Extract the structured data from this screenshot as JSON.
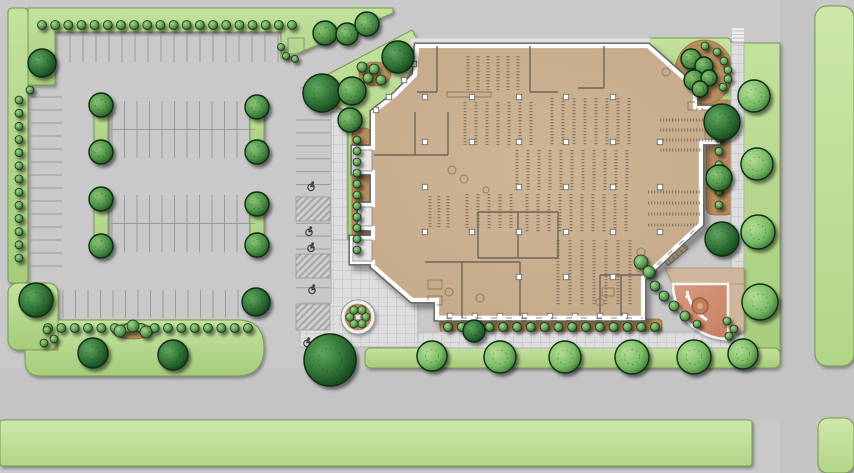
{
  "meta": {
    "type": "architectural-site-plan",
    "content": "color site plan: building floor plan with library-style shelving, parking lot, landscaping, plaza and roads",
    "text_labels": []
  },
  "canvas": {
    "w": 854,
    "h": 473,
    "bg": "#c9c9c9"
  },
  "palette": {
    "asphalt": "#c9c9c9",
    "road": "#c4c4c4",
    "grassStroke": "#7a9a52",
    "mulch": "#b78d5e",
    "mulchStroke": "#96713e",
    "walkFill": "#dedede",
    "walkLine": "#c0c0c0",
    "walkStroke": "#b2b2b2",
    "wallDark": "#5d5d5d",
    "wallWhite": "#fdfdfd",
    "shelf": "#7e6d58",
    "partition": "#6f655a",
    "stall": "#9b9b9b",
    "hatch": "#a6a6a6",
    "hcSymbol": "#3f3f3f",
    "plazaStroke": "#a96b50",
    "pavingTan": "#cfb79b",
    "fountain": "#c07d5c",
    "fountainRim": "#9c5f42",
    "fountainCore": "#dca584"
  },
  "roads": [
    {
      "x": 0,
      "y": 368,
      "w": 854,
      "h": 52
    },
    {
      "x": 780,
      "y": 0,
      "w": 36,
      "h": 473
    }
  ],
  "greens": [
    {
      "kind": "path",
      "d": "M28,8 H393 V13 L287,58 H281 V32 H55 V85 H28 Z",
      "tone": "main"
    },
    {
      "kind": "rect",
      "x": 8,
      "y": 8,
      "w": 20,
      "h": 275,
      "rx": 4,
      "tone": "main"
    },
    {
      "kind": "rect",
      "x": 8,
      "y": 283,
      "w": 50,
      "h": 67,
      "rx": 10,
      "tone": "main"
    },
    {
      "kind": "path",
      "d": "M25,350 H58 V320 H238 Q264,320 264,348 Q264,376 236,376 H40 Q25,376 25,360 Z",
      "tone": "main"
    },
    {
      "kind": "rect",
      "x": 94,
      "y": 100,
      "w": 14,
      "h": 56,
      "rx": 6,
      "tone": "main"
    },
    {
      "kind": "rect",
      "x": 250,
      "y": 100,
      "w": 14,
      "h": 56,
      "rx": 6,
      "tone": "main"
    },
    {
      "kind": "rect",
      "x": 94,
      "y": 196,
      "w": 14,
      "h": 56,
      "rx": 6,
      "tone": "main"
    },
    {
      "kind": "rect",
      "x": 250,
      "y": 196,
      "w": 14,
      "h": 56,
      "rx": 6,
      "tone": "main"
    },
    {
      "kind": "path",
      "d": "M302,88 L412,30 L424,52 L380,116 L380,268 L348,268 L348,112 Z",
      "tone": "main"
    },
    {
      "kind": "rect",
      "x": 645,
      "y": 38,
      "w": 86,
      "h": 75,
      "rx": 4,
      "tone": "main"
    },
    {
      "kind": "path",
      "d": "M742,43 H780 V350 Q780,366 764,366 H758 Q742,366 742,350 Z",
      "tone": "main"
    },
    {
      "kind": "rect",
      "x": 365,
      "y": 348,
      "w": 415,
      "h": 20,
      "rx": 6,
      "tone": "main"
    },
    {
      "kind": "rect",
      "x": 0,
      "y": 420,
      "w": 752,
      "h": 46,
      "rx": 3,
      "tone": "light"
    },
    {
      "kind": "rect",
      "x": 815,
      "y": 6,
      "w": 39,
      "h": 360,
      "rx": 12,
      "tone": "light"
    },
    {
      "kind": "rect",
      "x": 818,
      "y": 418,
      "w": 36,
      "h": 55,
      "rx": 10,
      "tone": "light"
    }
  ],
  "mulch": [
    {
      "kind": "ellipse",
      "cx": 375,
      "cy": 74,
      "rx": 16,
      "ry": 12
    },
    {
      "kind": "rect",
      "x": 352,
      "y": 128,
      "w": 20,
      "h": 124,
      "rx": 8
    },
    {
      "kind": "rect",
      "x": 440,
      "y": 319,
      "w": 222,
      "h": 14,
      "rx": 4
    },
    {
      "kind": "rect",
      "x": 706,
      "y": 100,
      "w": 28,
      "h": 115,
      "rx": 8
    },
    {
      "kind": "ellipse",
      "cx": 704,
      "cy": 72,
      "rx": 29,
      "ry": 32
    },
    {
      "kind": "ellipse",
      "cx": 643,
      "cy": 268,
      "rx": 14,
      "ry": 12
    },
    {
      "kind": "ellipse",
      "cx": 732,
      "cy": 326,
      "rx": 11,
      "ry": 10
    },
    {
      "kind": "ellipse",
      "cx": 133,
      "cy": 331,
      "rx": 21,
      "ry": 8
    }
  ],
  "walks": {
    "grid": [
      {
        "kind": "rect",
        "x": 331,
        "y": 112,
        "w": 16,
        "h": 132
      },
      {
        "kind": "path",
        "d": "M331,240 H418 V347 H300 V303 H331 Z"
      },
      {
        "kind": "rect",
        "x": 418,
        "y": 332,
        "w": 326,
        "h": 16
      },
      {
        "kind": "rect",
        "x": 731,
        "y": 43,
        "w": 13,
        "h": 305
      }
    ],
    "plain": [
      {
        "kind": "rect",
        "x": 410,
        "y": 38,
        "w": 240,
        "h": 9
      }
    ],
    "crosswalk": {
      "x": 732,
      "w": 12,
      "h": 2.4,
      "ys": [
        28,
        31.6,
        35.2,
        38.8
      ]
    }
  },
  "parking": {
    "stall_groups": [
      {
        "dir": "v",
        "y1": 33,
        "y2": 62,
        "x1": 57,
        "x2": 289,
        "step": 13
      },
      {
        "dir": "h",
        "x1": 30,
        "x2": 62,
        "y1": 97,
        "y2": 278,
        "step": 13
      },
      {
        "dir": "v",
        "y1": 101,
        "y2": 158,
        "x1": 112,
        "x2": 250,
        "step": 12.5,
        "divider": {
          "y": 129.5,
          "x1": 107,
          "x2": 255
        }
      },
      {
        "dir": "v",
        "y1": 195,
        "y2": 252,
        "x1": 112,
        "x2": 250,
        "step": 12.5,
        "divider": {
          "y": 223.5,
          "x1": 107,
          "x2": 255
        }
      },
      {
        "dir": "v",
        "y1": 290,
        "y2": 318,
        "x1": 63,
        "x2": 250,
        "step": 12.5
      },
      {
        "dir": "h",
        "x1": 296,
        "x2": 330,
        "y1": 120,
        "y2": 300,
        "step": 12.9
      }
    ],
    "hc_hatches": [
      [
        296,
        197,
        34,
        24
      ],
      [
        296,
        254,
        34,
        24
      ],
      [
        296,
        304,
        34,
        26
      ]
    ],
    "hc_symbols": [
      [
        311,
        186
      ],
      [
        309,
        231
      ],
      [
        311,
        247
      ],
      [
        312,
        289
      ],
      [
        307,
        342
      ]
    ],
    "pad": {
      "x": 288,
      "y": 38,
      "w": 16,
      "h": 16
    }
  },
  "building": {
    "outline": "M417,46 L648,46 L695,88 L695,108 L718,108 L718,142 L701,142 L701,224 L643,278 L643,318 L437,318 L437,300 L412,300 L373,266 L373,262 L352,262 L352,238 L373,238 L373,228 L360,228 L360,205 L373,205 L373,172 L354,172 L354,148 L373,148 L373,112 L395,95 L415,75 Z",
    "partitions": [
      [
        437,
        46,
        437,
        92
      ],
      [
        417,
        92,
        437,
        92
      ],
      [
        530,
        46,
        530,
        92
      ],
      [
        530,
        92,
        558,
        92
      ],
      [
        604,
        46,
        604,
        88
      ],
      [
        578,
        88,
        604,
        88
      ],
      [
        478,
        212,
        558,
        212
      ],
      [
        478,
        258,
        558,
        258
      ],
      [
        478,
        212,
        478,
        258
      ],
      [
        558,
        212,
        558,
        258
      ],
      [
        518,
        212,
        518,
        258
      ],
      [
        425,
        262,
        520,
        262
      ],
      [
        462,
        262,
        462,
        318
      ],
      [
        520,
        262,
        520,
        318
      ],
      [
        600,
        275,
        643,
        275
      ],
      [
        600,
        275,
        600,
        318
      ],
      [
        621,
        275,
        621,
        318
      ],
      [
        374,
        155,
        448,
        155
      ],
      [
        448,
        112,
        448,
        155
      ],
      [
        415,
        112,
        415,
        155
      ]
    ],
    "shelves": [
      [
        465,
        102,
        75,
        43,
        "v",
        11
      ],
      [
        552,
        98,
        83,
        47,
        "v",
        11
      ],
      [
        517,
        150,
        116,
        40,
        "v",
        11
      ],
      [
        467,
        194,
        46,
        34,
        "v",
        11
      ],
      [
        527,
        194,
        106,
        38,
        "v",
        11
      ],
      [
        558,
        240,
        72,
        66,
        "v",
        12
      ],
      [
        660,
        120,
        52,
        30,
        "h",
        10
      ],
      [
        648,
        192,
        52,
        36,
        "h",
        11
      ],
      [
        430,
        196,
        26,
        32,
        "v",
        9
      ],
      [
        468,
        56,
        50,
        34,
        "v",
        10
      ]
    ],
    "columns": [
      [
        425,
        97
      ],
      [
        472,
        97
      ],
      [
        519,
        97
      ],
      [
        566,
        97
      ],
      [
        613,
        97
      ],
      [
        425,
        142
      ],
      [
        472,
        142
      ],
      [
        519,
        142
      ],
      [
        566,
        142
      ],
      [
        613,
        142
      ],
      [
        660,
        142
      ],
      [
        425,
        187
      ],
      [
        519,
        187
      ],
      [
        566,
        187
      ],
      [
        613,
        187
      ],
      [
        660,
        187
      ],
      [
        425,
        232
      ],
      [
        472,
        232
      ],
      [
        519,
        232
      ],
      [
        566,
        232
      ],
      [
        613,
        232
      ],
      [
        660,
        232
      ],
      [
        519,
        277
      ],
      [
        566,
        277
      ],
      [
        613,
        277
      ],
      [
        414,
        64
      ],
      [
        404,
        80
      ],
      [
        389,
        97
      ],
      [
        376,
        110
      ],
      [
        450,
        316
      ],
      [
        475,
        316
      ],
      [
        500,
        316
      ],
      [
        525,
        316
      ],
      [
        550,
        316
      ],
      [
        575,
        316
      ],
      [
        600,
        316
      ],
      [
        625,
        316
      ]
    ],
    "vestibules": [
      [
        353,
        150,
        19,
        21
      ],
      [
        361,
        207,
        11,
        19
      ],
      [
        353,
        240,
        19,
        21
      ]
    ],
    "dashed_walls": [
      "M437,318 H643",
      "M701,224 L643,278"
    ],
    "furniture_rects": [
      [
        447,
        92,
        44,
        5
      ],
      [
        705,
        113,
        11,
        26
      ],
      [
        428,
        280,
        14,
        9
      ],
      [
        428,
        296,
        14,
        9
      ],
      [
        602,
        288,
        12,
        8
      ],
      [
        688,
        102,
        9,
        8
      ],
      [
        702,
        102,
        9,
        8
      ]
    ],
    "furniture_circles": [
      [
        452,
        170,
        4
      ],
      [
        464,
        179,
        4
      ],
      [
        449,
        292,
        4
      ],
      [
        480,
        298,
        4
      ],
      [
        641,
        252,
        4
      ],
      [
        600,
        302,
        4
      ],
      [
        486,
        190,
        3
      ],
      [
        673,
        63,
        4
      ],
      [
        666,
        72,
        4
      ]
    ],
    "stairs": {
      "x": 660,
      "y": 243,
      "w": 26,
      "h": 16,
      "rot": -40,
      "cx": 673,
      "cy": 251
    }
  },
  "plaza": {
    "quarter": "M728,284 L673,284 A55,55 0 0 0 728,339 Z",
    "tan_top": "M665,268 H744 V284 H673 Z",
    "tan_right": "M728,284 H744 V330 L728,339 Z",
    "bench": "M707,320 A42,42 0 0 1 687,291",
    "bench_dots": [
      [
        701,
        314
      ],
      [
        692,
        305
      ],
      [
        687,
        297
      ]
    ],
    "fountain": {
      "cx": 700,
      "cy": 306,
      "r": 8,
      "core": 3
    }
  },
  "planter": {
    "cx": 358,
    "cy": 317,
    "r_out": 17,
    "r_ring": 15,
    "shrub_r": 4.2,
    "ring_r": 8,
    "n": 6
  },
  "shrub_rows": [
    {
      "x1": 42,
      "y1": 25,
      "x2": 292,
      "y2": 25,
      "n": 20,
      "r": 4.5
    },
    {
      "x1": 19,
      "y1": 100,
      "x2": 19,
      "y2": 258,
      "n": 13,
      "r": 4
    },
    {
      "x1": 48,
      "y1": 328,
      "x2": 248,
      "y2": 328,
      "n": 16,
      "r": 4.5
    },
    {
      "x1": 357,
      "y1": 140,
      "x2": 357,
      "y2": 250,
      "n": 11,
      "r": 4
    },
    {
      "x1": 719,
      "y1": 138,
      "x2": 719,
      "y2": 205,
      "n": 6,
      "r": 4
    },
    {
      "x1": 448,
      "y1": 327,
      "x2": 655,
      "y2": 327,
      "n": 16,
      "r": 4.5
    }
  ],
  "shrubs": [
    [
      281,
      47,
      3.5
    ],
    [
      286,
      56,
      3.5
    ],
    [
      295,
      59,
      3.5
    ],
    [
      120,
      331,
      6
    ],
    [
      133,
      326,
      6
    ],
    [
      146,
      332,
      6
    ],
    [
      705,
      46,
      4
    ],
    [
      717,
      52,
      4
    ],
    [
      724,
      61,
      4
    ],
    [
      728,
      70,
      4
    ],
    [
      728,
      79,
      4
    ],
    [
      723,
      87,
      4
    ],
    [
      655,
      286,
      5
    ],
    [
      664,
      296,
      5
    ],
    [
      674,
      306,
      5
    ],
    [
      685,
      316,
      5
    ],
    [
      697,
      324,
      4
    ],
    [
      641,
      262,
      7
    ],
    [
      649,
      272,
      6
    ],
    [
      727,
      321,
      4
    ],
    [
      734,
      329,
      4
    ],
    [
      729,
      336,
      4
    ],
    [
      47,
      330,
      4
    ],
    [
      54,
      339,
      4
    ],
    [
      44,
      343,
      4
    ],
    [
      362,
      67,
      5
    ],
    [
      374,
      69,
      5
    ],
    [
      368,
      78,
      5
    ],
    [
      381,
      80,
      5
    ],
    [
      30,
      90,
      4
    ]
  ],
  "trees": [
    [
      42,
      63,
      14,
      "d"
    ],
    [
      36,
      300,
      17,
      "d"
    ],
    [
      322,
      93,
      19,
      "d"
    ],
    [
      398,
      57,
      16,
      "d"
    ],
    [
      93,
      353,
      15,
      "d"
    ],
    [
      173,
      355,
      15,
      "d"
    ],
    [
      256,
      302,
      14,
      "d"
    ],
    [
      722,
      122,
      18,
      "d"
    ],
    [
      722,
      239,
      17,
      "d"
    ],
    [
      474,
      331,
      11,
      "d"
    ],
    [
      101,
      105,
      12,
      "m"
    ],
    [
      101,
      152,
      12,
      "m"
    ],
    [
      257,
      107,
      12,
      "m"
    ],
    [
      257,
      152,
      12,
      "m"
    ],
    [
      101,
      199,
      12,
      "m"
    ],
    [
      101,
      246,
      12,
      "m"
    ],
    [
      257,
      204,
      12,
      "m"
    ],
    [
      257,
      245,
      12,
      "m"
    ],
    [
      325,
      33,
      12,
      "m"
    ],
    [
      347,
      34,
      11,
      "m"
    ],
    [
      367,
      24,
      12,
      "m"
    ],
    [
      352,
      91,
      14,
      "m"
    ],
    [
      350,
      120,
      12,
      "m"
    ],
    [
      719,
      178,
      13,
      "m"
    ],
    [
      691,
      59,
      10,
      "m"
    ],
    [
      704,
      66,
      9,
      "m"
    ],
    [
      694,
      80,
      10,
      "m"
    ],
    [
      709,
      78,
      8,
      "m"
    ],
    [
      700,
      89,
      8,
      "m"
    ],
    [
      432,
      356,
      15,
      "l"
    ],
    [
      500,
      357,
      16,
      "l"
    ],
    [
      565,
      357,
      16,
      "l"
    ],
    [
      632,
      357,
      17,
      "l"
    ],
    [
      694,
      357,
      17,
      "l"
    ],
    [
      743,
      354,
      15,
      "l"
    ],
    [
      754,
      96,
      16,
      "l"
    ],
    [
      757,
      164,
      16,
      "l"
    ],
    [
      758,
      232,
      17,
      "l"
    ],
    [
      760,
      302,
      18,
      "l"
    ],
    [
      330,
      360,
      26,
      "d"
    ]
  ]
}
